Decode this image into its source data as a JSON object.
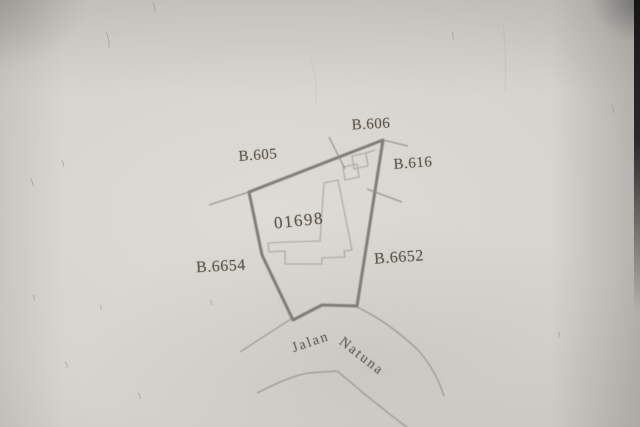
{
  "map": {
    "parcel_id": "01698",
    "markers": {
      "b605": "B.605",
      "b606": "B.606",
      "b616": "B.616",
      "b6652": "B.6652",
      "b6654": "B.6654"
    },
    "road_name": {
      "word1": "Jalan",
      "word2": "Natuna"
    },
    "colors": {
      "paper": "#d6d3ce",
      "ink_text": "#5d594f",
      "boundary_line": "#75736e",
      "thin_line": "#8f8c86",
      "building_line": "#9a9790",
      "photo_edge": "#1a1a1a"
    }
  }
}
